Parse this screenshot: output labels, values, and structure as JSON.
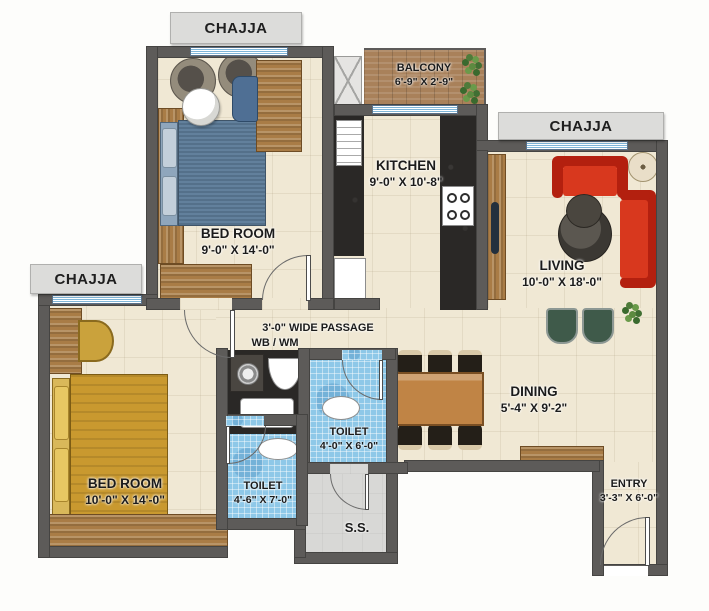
{
  "labels": {
    "chajja_top": "CHAJJA",
    "chajja_right": "CHAJJA",
    "chajja_left": "CHAJJA",
    "passage": "3'-0\" WIDE PASSAGE",
    "wb_wm": "WB / WM",
    "ss": "S.S."
  },
  "rooms": {
    "balcony": {
      "name": "BALCONY",
      "dims": "6'-9\" X 2'-9\""
    },
    "kitchen": {
      "name": "KITCHEN",
      "dims": "9'-0\" X 10'-8\""
    },
    "living": {
      "name": "LIVING",
      "dims": "10'-0\" X 18'-0\""
    },
    "bedroom_top": {
      "name": "BED ROOM",
      "dims": "9'-0\" X 14'-0\""
    },
    "bedroom_bottom": {
      "name": "BED ROOM",
      "dims": "10'-0\" X 14'-0\""
    },
    "dining": {
      "name": "DINING",
      "dims": "5'-4\" X 9'-2\""
    },
    "toilet_upper": {
      "name": "TOILET",
      "dims": "4'-0\" X 6'-0\""
    },
    "toilet_lower": {
      "name": "TOILET",
      "dims": "4'-6\" X 7'-0\""
    },
    "entry": {
      "name": "ENTRY",
      "dims": "3'-3\" X 6'-0\""
    }
  },
  "colors": {
    "wall": "#5d5b59",
    "floor_tile": "#f0e8d4",
    "toilet_tile": "#8ec8e8",
    "ss_floor": "#d8d8d6",
    "wood": "#a97c46",
    "granite_counter": "#2a2826",
    "sofa_red": "#d2301c",
    "bed_blue": "#5d7790",
    "bed_gold": "#c9992f",
    "chair_green": "#3f5a4a",
    "label_box": "#dcdcda",
    "window_blue": "#7fb6d9"
  }
}
